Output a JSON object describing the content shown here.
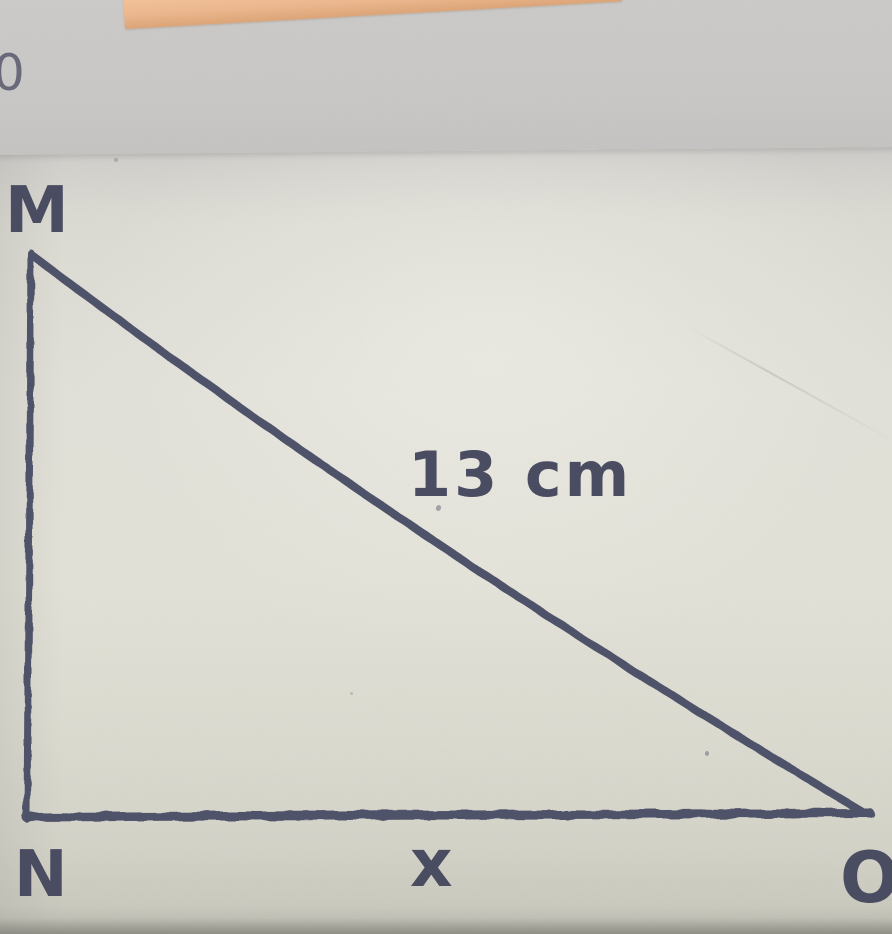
{
  "photo": {
    "margin_number": "0",
    "tape_color": "#ecb68c",
    "paper_color": "#e1e0d8",
    "ink_color": "#50526a"
  },
  "figure": {
    "type": "right-triangle",
    "right_angle_at": "N",
    "vertices": {
      "top": "M",
      "bottom_left": "N",
      "bottom_right": "O"
    },
    "sides": {
      "hypotenuse_label": "13 cm",
      "base_label": "x"
    }
  }
}
